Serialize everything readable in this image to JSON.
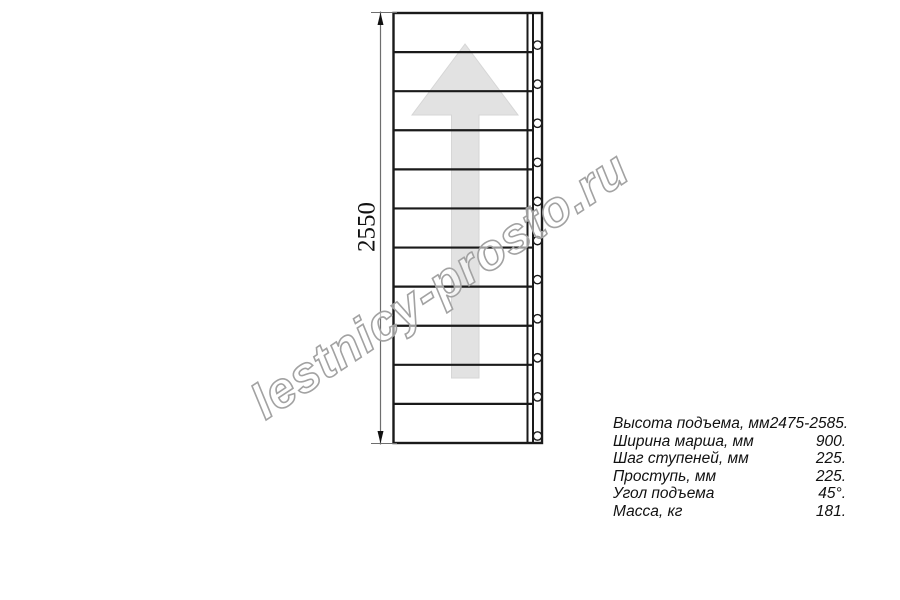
{
  "drawing": {
    "dimension_label": "2550",
    "tread_count": 11,
    "fastener_count": 11
  },
  "watermark": {
    "text": "lestnicy-prosto.ru"
  },
  "specs": {
    "rows": [
      {
        "label": "Высота подъема, мм",
        "value": "2475-2585."
      },
      {
        "label": "Ширина марша, мм",
        "value": "900."
      },
      {
        "label": "Шаг ступеней, мм",
        "value": "225."
      },
      {
        "label": "Проступь, мм",
        "value": "225."
      },
      {
        "label": "Угол подъема",
        "value": "45°."
      },
      {
        "label": "Масса, кг",
        "value": "181."
      }
    ]
  },
  "colors": {
    "line": "#1a1a1a",
    "dim_line": "#6e6e6e",
    "dim_arrow": "#111111",
    "arrow_fill": "#e2e2e2",
    "arrow_edge": "#d6d6d6",
    "watermark_stroke": "#a2a2a2",
    "watermark_fill": "rgba(255,255,255,0.55)"
  }
}
